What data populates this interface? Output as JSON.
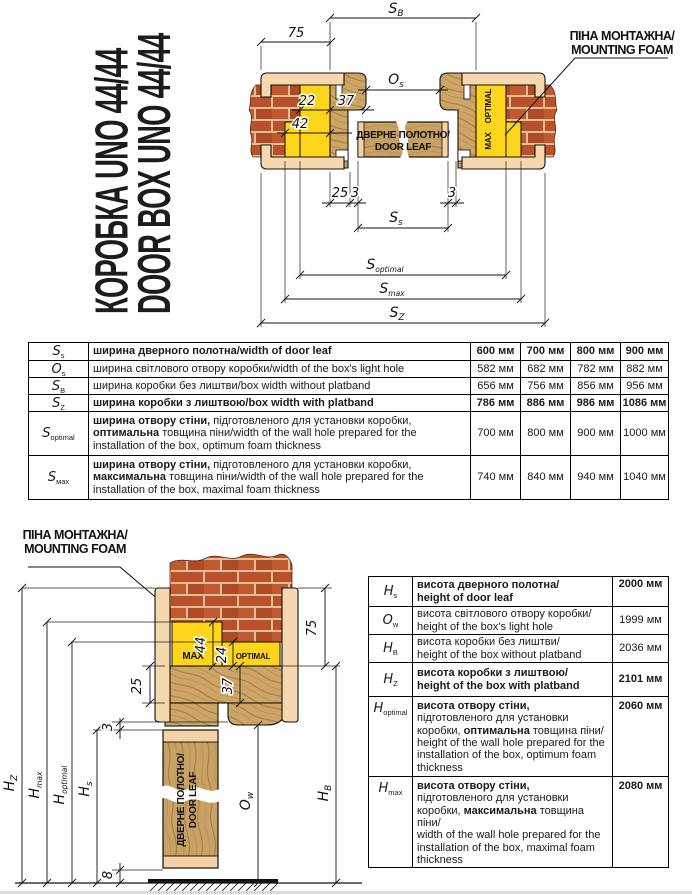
{
  "title": {
    "line1": "КОРОБКА UNO 44/44",
    "line2": "DOOR BOX UNO 44/44"
  },
  "foam_callout": {
    "line1": "ПІНА МОНТАЖНА/",
    "line2": "MOUNTING FOAM"
  },
  "door_leaf": {
    "line1": "ДВЕРНЕ ПОЛОТНО/",
    "line2": "DOOR LEAF"
  },
  "bands": {
    "max": "MAX",
    "optimal": "OPTIMAL"
  },
  "top_diagram": {
    "dims": {
      "platband_width": "75",
      "foam_optimal": "22",
      "box_depth": "37",
      "foam_max": "42",
      "stop_offset": "25",
      "gap_left": "3",
      "gap_right": "3"
    },
    "labels": {
      "sb_base": "S",
      "sb_sub": "B",
      "os_base": "O",
      "os_sub": "s",
      "ss_base": "S",
      "ss_sub": "s",
      "sopt_base": "S",
      "sopt_sub": "optimal",
      "smax_base": "S",
      "smax_sub": "max",
      "sz_base": "S",
      "sz_sub": "Z"
    }
  },
  "bottom_diagram": {
    "dims": {
      "platband_width": "75",
      "foam_max": "44",
      "foam_optimal": "24",
      "box_depth": "37",
      "stop_offset": "25",
      "top_gap": "3",
      "bottom_gap": "8"
    },
    "labels": {
      "hz_base": "H",
      "hz_sub": "Z",
      "hmax_base": "H",
      "hmax_sub": "max",
      "hopt_base": "H",
      "hopt_sub": "optimal",
      "hs_base": "H",
      "hs_sub": "s",
      "ow_base": "O",
      "ow_sub": "w",
      "hb_base": "H",
      "hb_sub": "B"
    }
  },
  "width_table": {
    "rows": [
      {
        "sym_base": "S",
        "sym_sub": "s",
        "vbold": true,
        "desc": [
          {
            "t": "ширина дверного полотна/width of door leaf",
            "b": true
          }
        ],
        "values": [
          "600 мм",
          "700 мм",
          "800 мм",
          "900 мм"
        ]
      },
      {
        "sym_base": "O",
        "sym_sub": "s",
        "vbold": false,
        "desc": [
          {
            "t": "ширина світлового отвору коробки/width of the box's light hole",
            "b": false
          }
        ],
        "values": [
          "582 мм",
          "682 мм",
          "782 мм",
          "882 мм"
        ]
      },
      {
        "sym_base": "S",
        "sym_sub": "B",
        "vbold": false,
        "desc": [
          {
            "t": "ширина коробки без лиштви/box width without platband",
            "b": false
          }
        ],
        "values": [
          "656 мм",
          "756 мм",
          "856 мм",
          "956 мм"
        ]
      },
      {
        "sym_base": "S",
        "sym_sub": "Z",
        "vbold": true,
        "desc": [
          {
            "t": "ширина коробки з лиштвою/box width with platband",
            "b": true
          }
        ],
        "values": [
          "786 мм",
          "886 мм",
          "986 мм",
          "1086 мм"
        ]
      },
      {
        "sym_base": "S",
        "sym_sub": "optimal",
        "vbold": false,
        "desc": [
          {
            "t": "ширина отвору стіни,",
            "b": true
          },
          {
            "t": " підготовленого для установки коробки,",
            "b": false
          },
          {
            "br": true
          },
          {
            "t": "оптимальна",
            "b": true
          },
          {
            "t": " товщина піни/width of the wall hole prepared for the installation of the box, optimum foam thickness",
            "b": false
          }
        ],
        "values": [
          "700 мм",
          "800 мм",
          "900 мм",
          "1000 мм"
        ]
      },
      {
        "sym_base": "S",
        "sym_sub": "мах",
        "vbold": false,
        "desc": [
          {
            "t": "ширина отвору стіни,",
            "b": true
          },
          {
            "t": " підготовленого для установки коробки,",
            "b": false
          },
          {
            "br": true
          },
          {
            "t": "максимальна",
            "b": true
          },
          {
            "t": " товщина піни/width of the wall hole prepared for the installation of the box, maximal foam thickness",
            "b": false
          }
        ],
        "values": [
          "740 мм",
          "840 мм",
          "940 мм",
          "1040 мм"
        ]
      }
    ]
  },
  "height_table": {
    "rows": [
      {
        "sym_base": "H",
        "sym_sub": "s",
        "vbold": true,
        "desc": [
          {
            "t": "висота дверного полотна/",
            "b": true
          },
          {
            "br": true
          },
          {
            "t": "height of door leaf",
            "b": true
          }
        ],
        "value": "2000 мм"
      },
      {
        "sym_base": "O",
        "sym_sub": "w",
        "vbold": false,
        "desc": [
          {
            "t": "висота світлового отвору коробки/",
            "b": false
          },
          {
            "br": true
          },
          {
            "t": "height of the box's light hole",
            "b": false
          }
        ],
        "value": "1999 мм"
      },
      {
        "sym_base": "H",
        "sym_sub": "B",
        "vbold": false,
        "desc": [
          {
            "t": "висота коробки без лиштви/",
            "b": false
          },
          {
            "br": true
          },
          {
            "t": "height of the box without platband",
            "b": false
          }
        ],
        "value": "2036 мм"
      },
      {
        "sym_base": "H",
        "sym_sub": "Z",
        "vbold": true,
        "desc": [
          {
            "t": "висота коробки з лиштвою/",
            "b": true
          },
          {
            "br": true
          },
          {
            "t": "height of the box with platband",
            "b": true
          }
        ],
        "value": "2101 мм"
      },
      {
        "sym_base": "H",
        "sym_sub": "optimal",
        "vbold": false,
        "desc": [
          {
            "t": "висота отвору стіни,",
            "b": true
          },
          {
            "t": " підготовленого для установки коробки, ",
            "b": false
          },
          {
            "t": "оптимальна",
            "b": true
          },
          {
            "t": " товщина піни/",
            "b": false
          },
          {
            "br": true
          },
          {
            "t": "height of the wall hole prepared for the installation of the box, optimum foam thickness",
            "b": false
          }
        ],
        "value": "2060 мм"
      },
      {
        "sym_base": "H",
        "sym_sub": "max",
        "vbold": false,
        "desc": [
          {
            "t": "висота отвору стіни,",
            "b": true
          },
          {
            "t": " підготовленого для установки коробки, ",
            "b": false
          },
          {
            "t": "максимальна",
            "b": true
          },
          {
            "t": " товщина піни/",
            "b": false
          },
          {
            "br": true
          },
          {
            "t": "width of the wall hole prepared for the installation of the box, maximal foam thickness",
            "b": false
          }
        ],
        "value": "2080 мм"
      }
    ]
  },
  "colors": {
    "foam": "#FFD51C",
    "brick": "#B8502A",
    "mortar": "#E2BE96",
    "wood": "#CDA567",
    "wood_grain": "#A57C3E",
    "platband": "#F7D8AE",
    "line": "#000000"
  }
}
